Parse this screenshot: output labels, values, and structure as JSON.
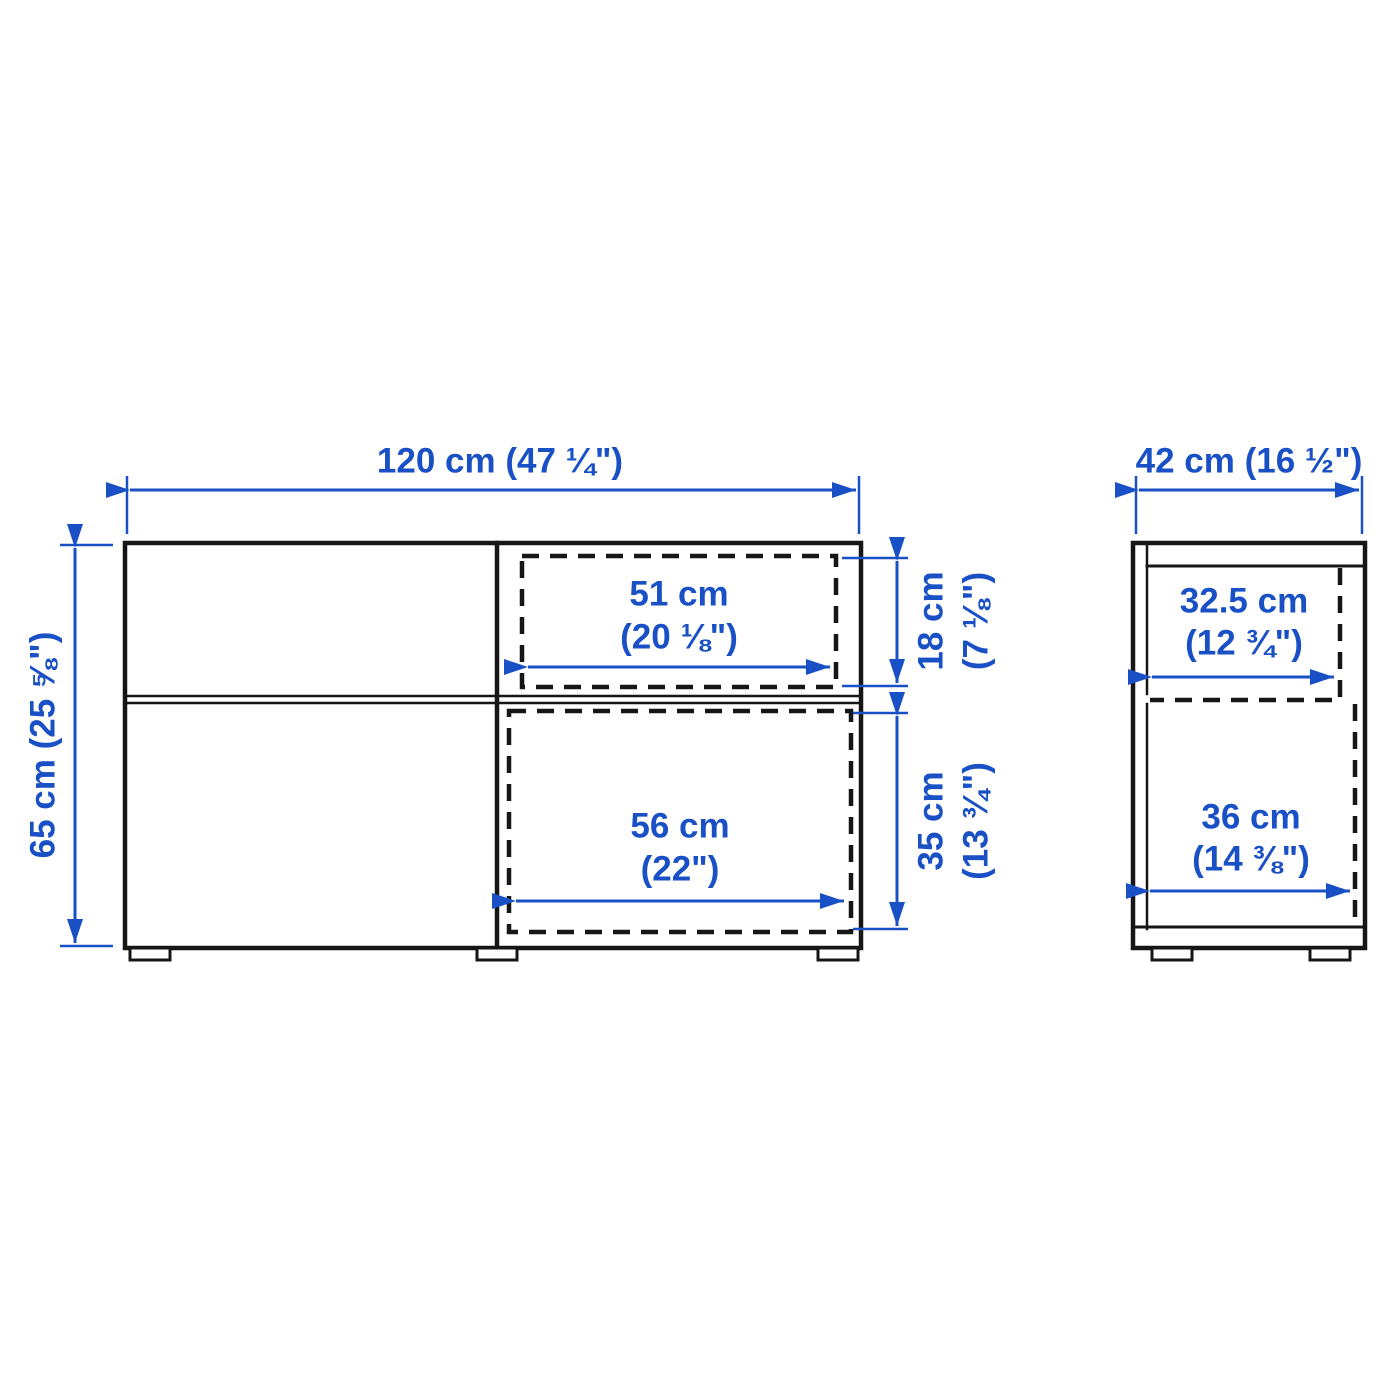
{
  "diagram": {
    "type": "furniture-dimension-diagram",
    "colors": {
      "dimension_blue": "#1A50C5",
      "outline_black": "#161616",
      "background": "#ffffff"
    },
    "front_view": {
      "overall_width_label": "120 cm (47 ¼\")",
      "overall_height_label": "65 cm (25 ⅝\")",
      "top_drawer_width_line1": "51 cm",
      "top_drawer_width_line2": "(20 ⅛\")",
      "top_drawer_height_line1": "18 cm",
      "top_drawer_height_line2": "(7 ⅛\")",
      "bottom_compartment_width_line1": "56 cm",
      "bottom_compartment_width_line2": "(22\")",
      "bottom_compartment_height_line1": "35 cm",
      "bottom_compartment_height_line2": "(13 ¾\")"
    },
    "side_view": {
      "overall_depth_label": "42 cm (16 ½\")",
      "top_drawer_depth_line1": "32.5 cm",
      "top_drawer_depth_line2": "(12 ¾\")",
      "bottom_compartment_depth_line1": "36 cm",
      "bottom_compartment_depth_line2": "(14 ⅜\")"
    }
  }
}
